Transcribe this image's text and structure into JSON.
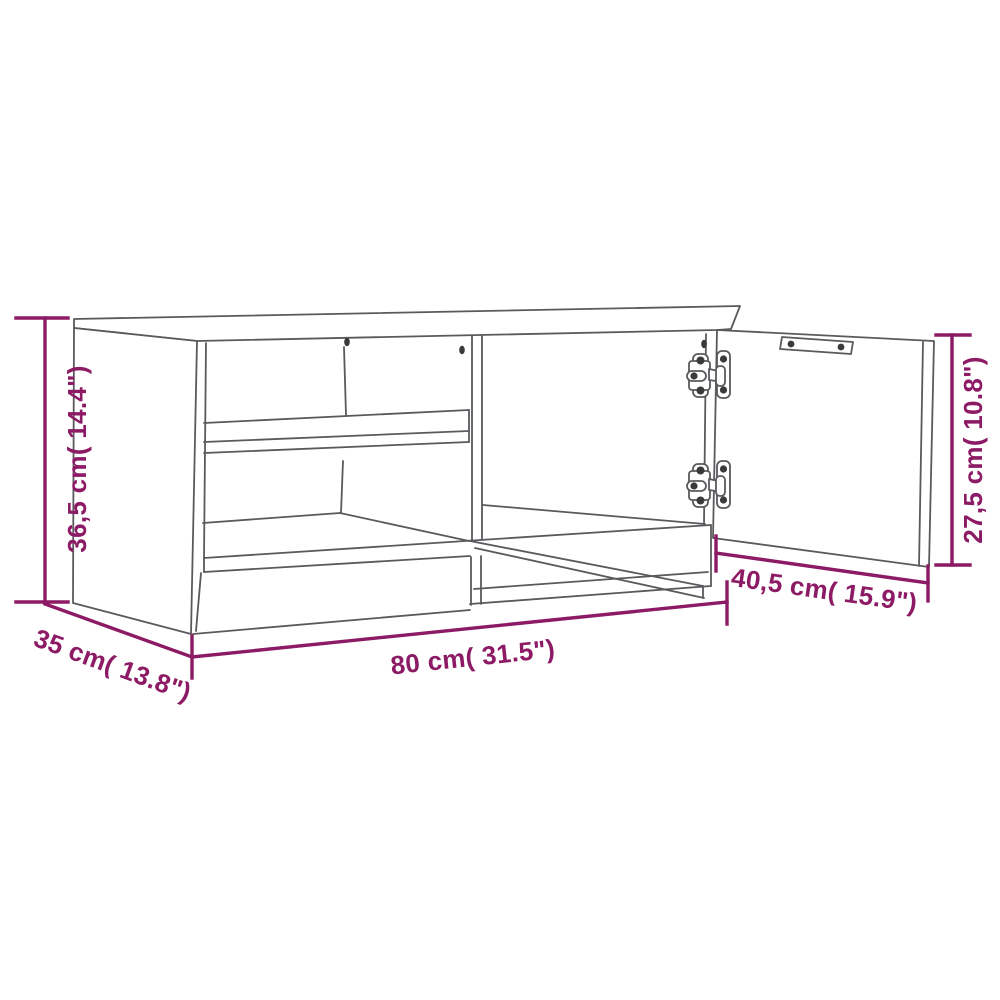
{
  "page": {
    "type": "product-dimension-diagram",
    "product": "TV cabinet wireframe with two-shelf open compartment and one open door"
  },
  "colors": {
    "dimension_accent": "#8C1A64",
    "outline_gray": "#5A5A5E",
    "screw_dark": "#3A3A3A",
    "background": "#ffffff"
  },
  "dimensions": {
    "overall_height": {
      "cm": "36,5",
      "inch": "14.4",
      "label": "36,5 cm( 14.4\")"
    },
    "overall_width": {
      "cm": "80",
      "inch": "31.5",
      "label": "80 cm( 31.5\")"
    },
    "overall_depth": {
      "cm": "35",
      "inch": "13.8",
      "label": "35 cm( 13.8\")"
    },
    "door_height": {
      "cm": "27,5",
      "inch": "10.8",
      "label": "27,5 cm( 10.8\")"
    },
    "door_width": {
      "cm": "40,5",
      "inch": "15.9",
      "label": "40,5 cm( 15.9\")"
    }
  }
}
